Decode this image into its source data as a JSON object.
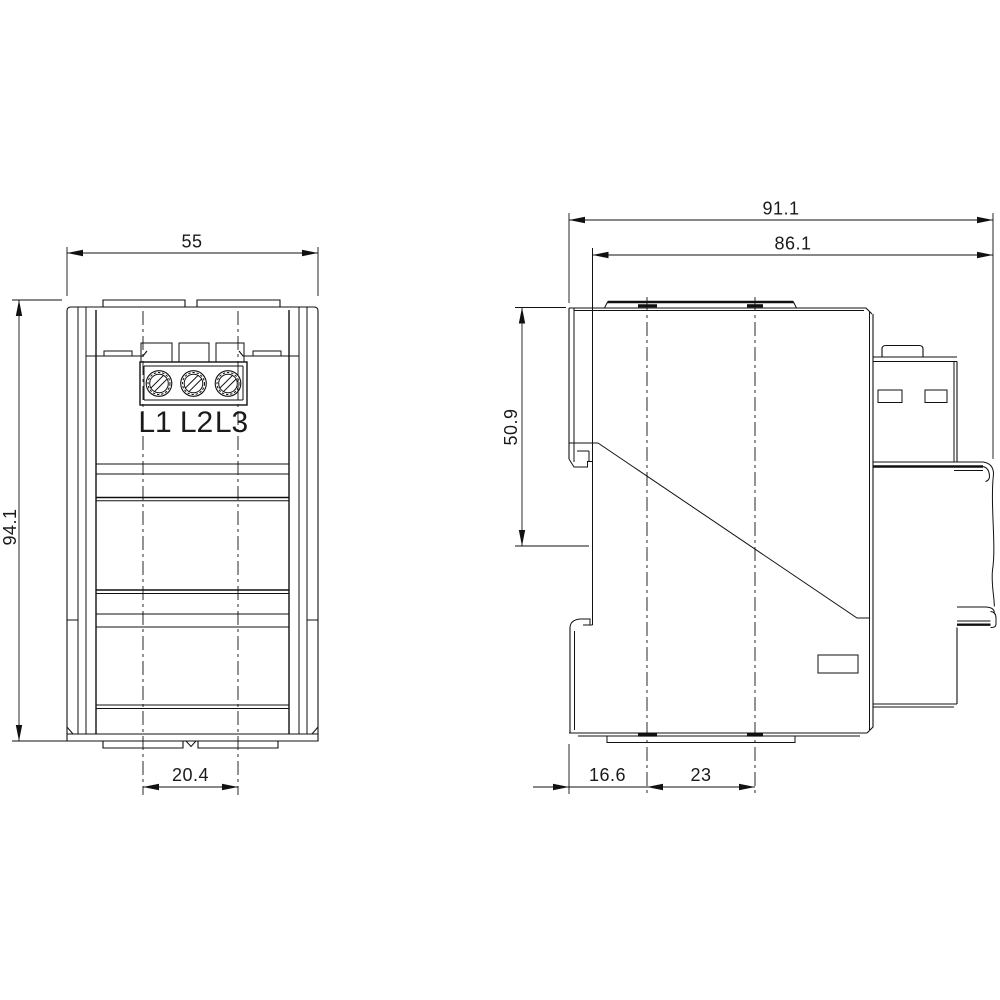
{
  "drawing": {
    "kind": "technical-dimension-drawing",
    "colors": {
      "background": "#ffffff",
      "line": "#111111",
      "text": "#1a1a1a"
    },
    "front_view": {
      "terminals": [
        "L1",
        "L2",
        "L3"
      ],
      "dimensions": {
        "overall_width": "55",
        "overall_height": "94.1",
        "foot_tab_spacing": "20.4"
      }
    },
    "side_view": {
      "dimensions": {
        "overall_depth": "91.1",
        "body_depth": "86.1",
        "upper_section_height": "50.9",
        "front_to_first_center": "16.6",
        "center_spacing": "23"
      }
    }
  }
}
